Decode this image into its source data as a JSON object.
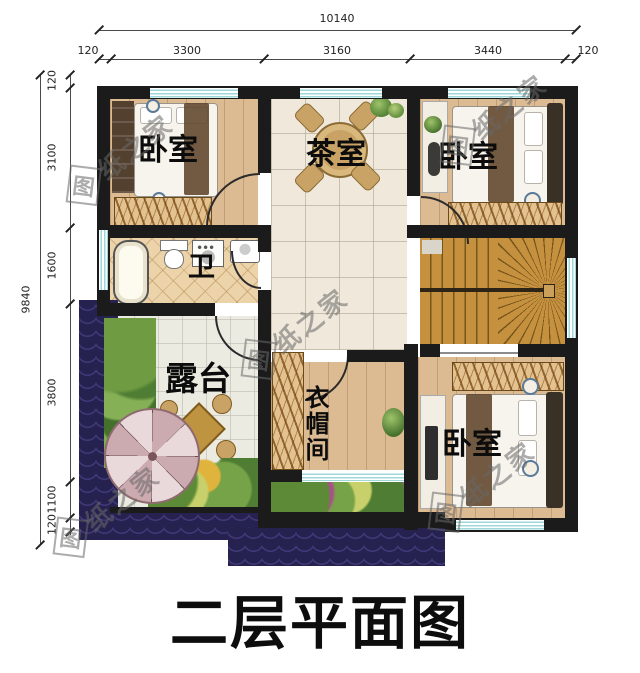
{
  "title": "二层平面图",
  "watermark": {
    "first": "图",
    "rest": "纸之家",
    "full": "图纸之家"
  },
  "dims": {
    "top_total": "10140",
    "top_segments": [
      "120",
      "3300",
      "3160",
      "3440",
      "120"
    ],
    "left_total": "9840",
    "left_segments": [
      "120",
      "3100",
      "1600",
      "3800",
      "1100",
      "120"
    ]
  },
  "rooms": {
    "bedroom_tl": "卧室",
    "tea_room": "茶室",
    "bedroom_tr": "卧室",
    "bathroom": "卫",
    "terrace": "露台",
    "cloakroom": "衣帽间",
    "bedroom_br": "卧室"
  },
  "colors": {
    "wall": "#1b1b1b",
    "window_stripe": "#9ed8d8",
    "roof_tile": "#26224f",
    "wood_floor": "#dcba92",
    "tile_floor": "#f0e9db",
    "terrace_floor": "#ecebe2",
    "bath_floor": "#ecd3aa",
    "stairs": "#c6913f"
  }
}
